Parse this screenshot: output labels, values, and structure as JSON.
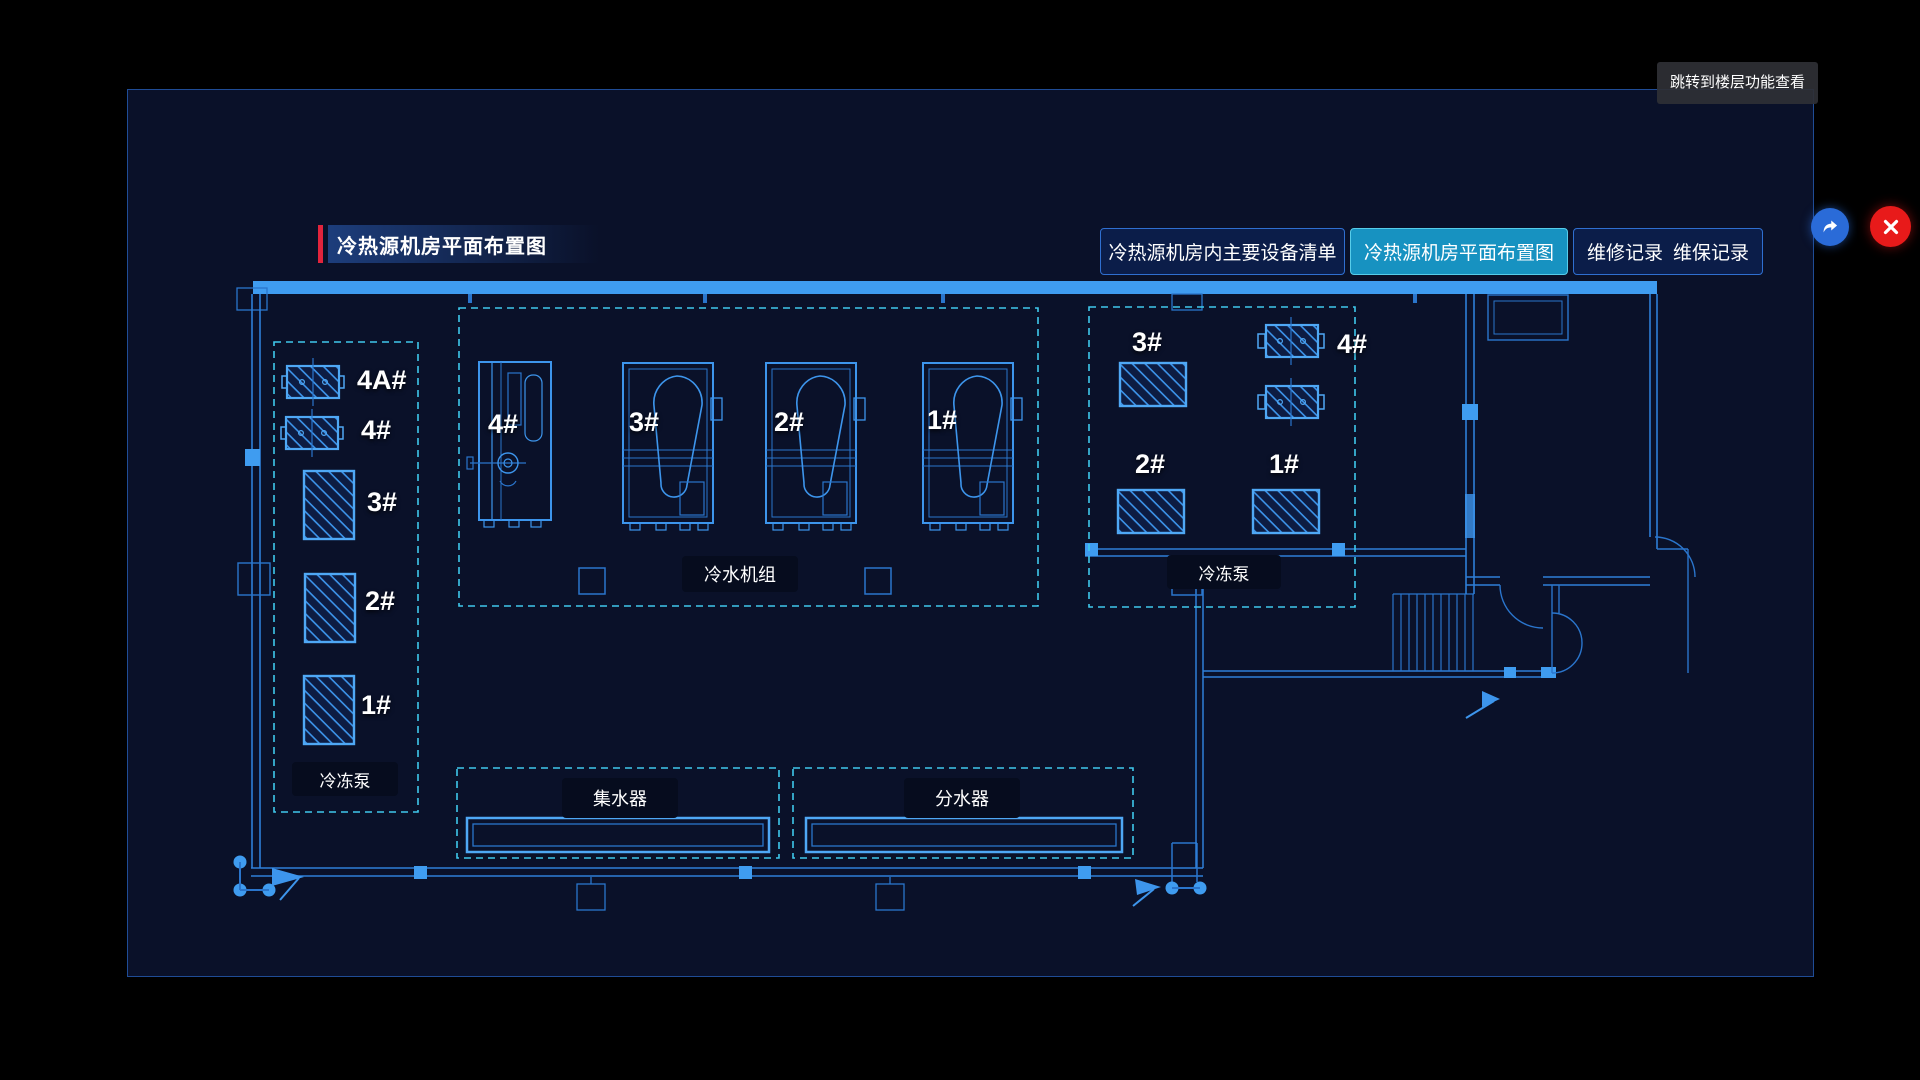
{
  "window": {
    "tooltip": "跳转到楼层功能查看"
  },
  "header": {
    "title": "冷热源机房平面布置图",
    "tabs": [
      {
        "label": "冷热源机房内主要设备清单",
        "active": false
      },
      {
        "label": "冷热源机房平面布置图",
        "active": true
      },
      {
        "label": "维修记录",
        "active": false
      },
      {
        "label": "维保记录",
        "active": false
      }
    ]
  },
  "plan": {
    "left_pump_group": {
      "caption": "冷冻泵",
      "units": [
        "4A#",
        "4#",
        "3#",
        "2#",
        "1#"
      ]
    },
    "chiller_group": {
      "caption": "冷水机组",
      "units": [
        "4#",
        "3#",
        "2#",
        "1#"
      ]
    },
    "right_pump_group": {
      "caption": "冷冻泵",
      "units": [
        "3#",
        "4#",
        "2#",
        "1#"
      ]
    },
    "collector": {
      "label": "集水器"
    },
    "distributor": {
      "label": "分水器"
    }
  },
  "colors": {
    "accent_red": "#e2243c",
    "active_tab": "#1792c1",
    "line_blue": "#3d95ec",
    "wall_fill": "#3f9cf0",
    "dashed_cyan": "#3fc8ec",
    "close_red": "#e81a1a",
    "button_blue": "#2a6bd8"
  }
}
